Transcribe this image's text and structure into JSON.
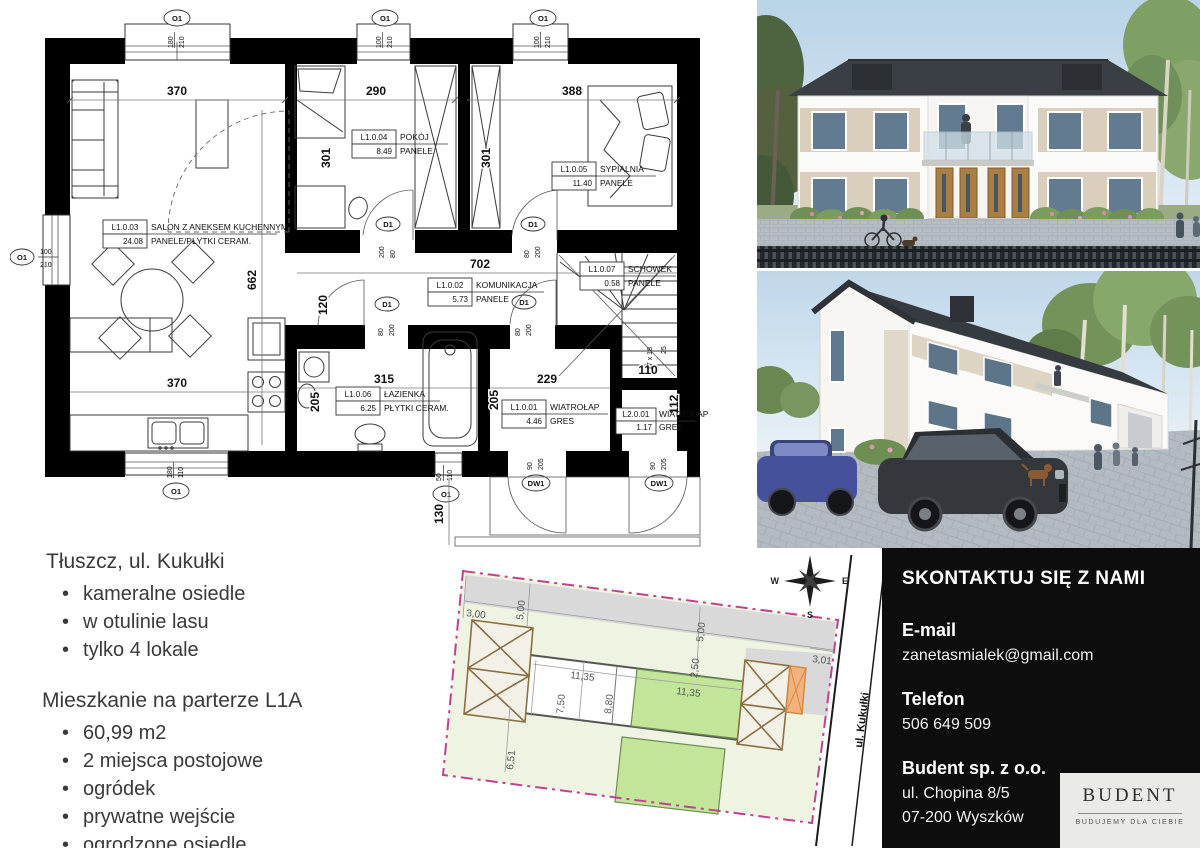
{
  "info": {
    "heading1": "Tłuszcz, ul. Kukułki",
    "bullets1": [
      "kameralne osiedle",
      "w otulinie lasu",
      "tylko 4 lokale"
    ],
    "heading2": "Mieszkanie na parterze L1A",
    "bullets2": [
      "60,99 m2",
      "2 miejsca postojowe",
      "ogródek",
      "prywatne wejście",
      "ogrodzone osiedle"
    ]
  },
  "contact": {
    "title": "SKONTAKTUJ SIĘ Z NAMI",
    "email_label": "E-mail",
    "email": "zanetasmialek@gmail.com",
    "phone_label": "Telefon",
    "phone": "506 649 509",
    "company": "Budent sp. z o.o.",
    "address1": "ul. Chopina 8/5",
    "address2": "07-200 Wyszków",
    "logo": {
      "name": "BUDENT",
      "tagline": "BUDUJEMY DLA CIEBIE"
    }
  },
  "floor_plan": {
    "rooms": [
      {
        "code": "L1.0.01",
        "name": "WIATROŁAP",
        "area": "4.46",
        "floor": "GRES"
      },
      {
        "code": "L1.0.02",
        "name": "KOMUNIKACJA",
        "area": "5.73",
        "floor": "PANELE"
      },
      {
        "code": "L1.0.03",
        "name": "SALON Z ANEKSEM KUCHENNYM",
        "area": "24.08",
        "floor": "PANELE/PŁYTKI CERAM."
      },
      {
        "code": "L1.0.04",
        "name": "POKÓJ",
        "area": "8.49",
        "floor": "PANELE"
      },
      {
        "code": "L1.0.05",
        "name": "SYPIALNIA",
        "area": "11.40",
        "floor": "PANELE"
      },
      {
        "code": "L1.0.06",
        "name": "ŁAZIENKA",
        "area": "6.25",
        "floor": "PŁYTKI CERAM."
      },
      {
        "code": "L1.0.07",
        "name": "SCHOWEK",
        "area": "0.58",
        "floor": "PANELE"
      },
      {
        "code": "L2.0.01",
        "name": "WIATROŁAP",
        "area": "1.17",
        "floor": "GRES"
      }
    ],
    "dims": {
      "salon_w": "370",
      "salon_h": "662",
      "kitchen_w": "370",
      "pokoj_w": "290",
      "pokoj_h": "301",
      "closet_h": "301",
      "sypialnia_w": "388",
      "corridor": "702",
      "gap": "120",
      "bath_w": "315",
      "bath_l": "205",
      "bath_r": "205",
      "entry_w": "229",
      "l2_w": "110",
      "l2_h": "112",
      "porch": "130",
      "stairs": "17 x 18",
      "stair_w": "25"
    },
    "windows": [
      {
        "id": "O1",
        "a": "180",
        "b": "210"
      },
      {
        "id": "O1",
        "a": "100",
        "b": "210"
      },
      {
        "id": "O1",
        "a": "100",
        "b": "210"
      },
      {
        "id": "O1",
        "a": "100",
        "b": "210"
      },
      {
        "id": "O1",
        "a": "180",
        "b": "110"
      },
      {
        "id": "O1",
        "a": "50",
        "b": "110"
      }
    ],
    "doors": [
      {
        "id": "D1",
        "a": "200",
        "b": "80"
      },
      {
        "id": "D1",
        "a": "80",
        "b": "200"
      },
      {
        "id": "D1",
        "a": "80",
        "b": "200"
      },
      {
        "id": "D1",
        "a": "80",
        "b": "200"
      },
      {
        "id": "DW1",
        "a": "90",
        "b": "205"
      },
      {
        "id": "DW1",
        "a": "90",
        "b": "205"
      }
    ]
  },
  "site_plan": {
    "street": "ul. Kukułki",
    "compass": {
      "n": "N",
      "e": "E",
      "s": "S",
      "w": "W"
    },
    "dims": [
      "3,00",
      "5,00",
      "5,00",
      "2,50",
      "3,01",
      "11,35",
      "7,50",
      "8,80",
      "11,35",
      "6,51"
    ]
  },
  "colors": {
    "boundary_magenta": "#c2418f",
    "garden_green": "#c2e59a",
    "site_pale_green": "#eef3e2",
    "site_gray": "#d9d9d9",
    "carport_brown": "#8a6f42",
    "carport_orange": "#f2b27c",
    "contact_bg": "#0d0d0d",
    "logo_bg": "#eaeae8",
    "roof_dark": "#383d43",
    "facade_beige": "#d9cfbc"
  }
}
